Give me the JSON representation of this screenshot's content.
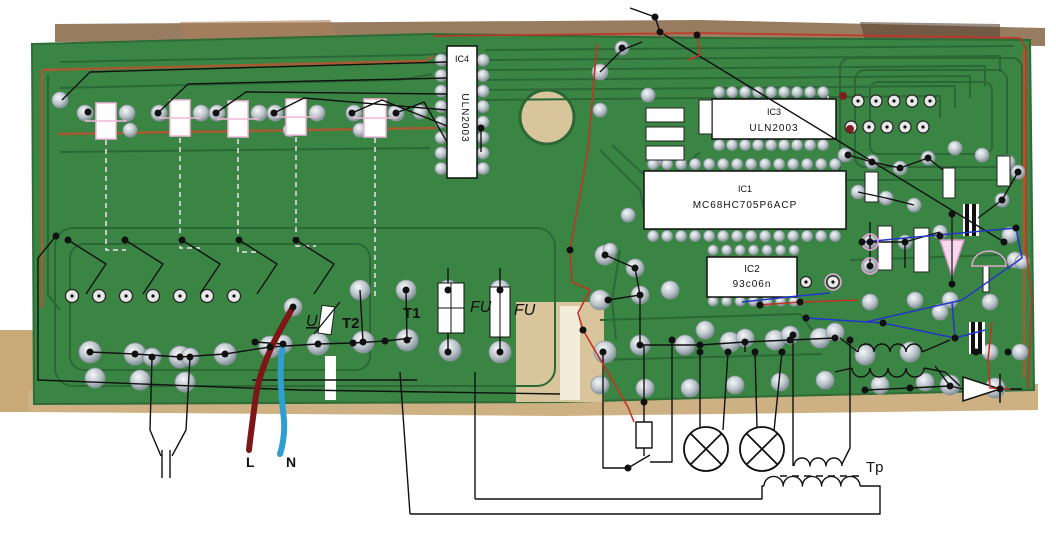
{
  "components": {
    "ic1": {
      "ref": "IC1",
      "part": "MC68HC705P6ACP"
    },
    "ic2": {
      "ref": "IC2",
      "part": "93c06n"
    },
    "ic3": {
      "ref": "IC3",
      "part": "ULN2003"
    },
    "ic4": {
      "ref": "IC4",
      "part": "ULN2003"
    }
  },
  "labels": {
    "varistor": "U",
    "transformer_t2": "T2",
    "transformer_t1": "T1",
    "fuse_1": "FU",
    "fuse_2": "FU",
    "wire_live": "L",
    "wire_neutral": "N",
    "transformer_tp": "Tp"
  },
  "colors": {
    "pcb_green": "#3a8544",
    "pcb_trace_dark": "#2b6836",
    "pcb_trace_deep": "#1f5229",
    "copper_trace": "#a85a32",
    "board_edge_tan": "#c49a62",
    "fabric": "#d9c59c",
    "table_brown": "#8d6e4f",
    "annotation_black": "#111111",
    "annotation_red": "#c23424",
    "annotation_blue": "#2336c8",
    "wire_live": "#7d1616",
    "wire_neutral": "#2e9fd0",
    "dashed_pink": "#f2b6dc",
    "component_white": "#ffffff"
  }
}
